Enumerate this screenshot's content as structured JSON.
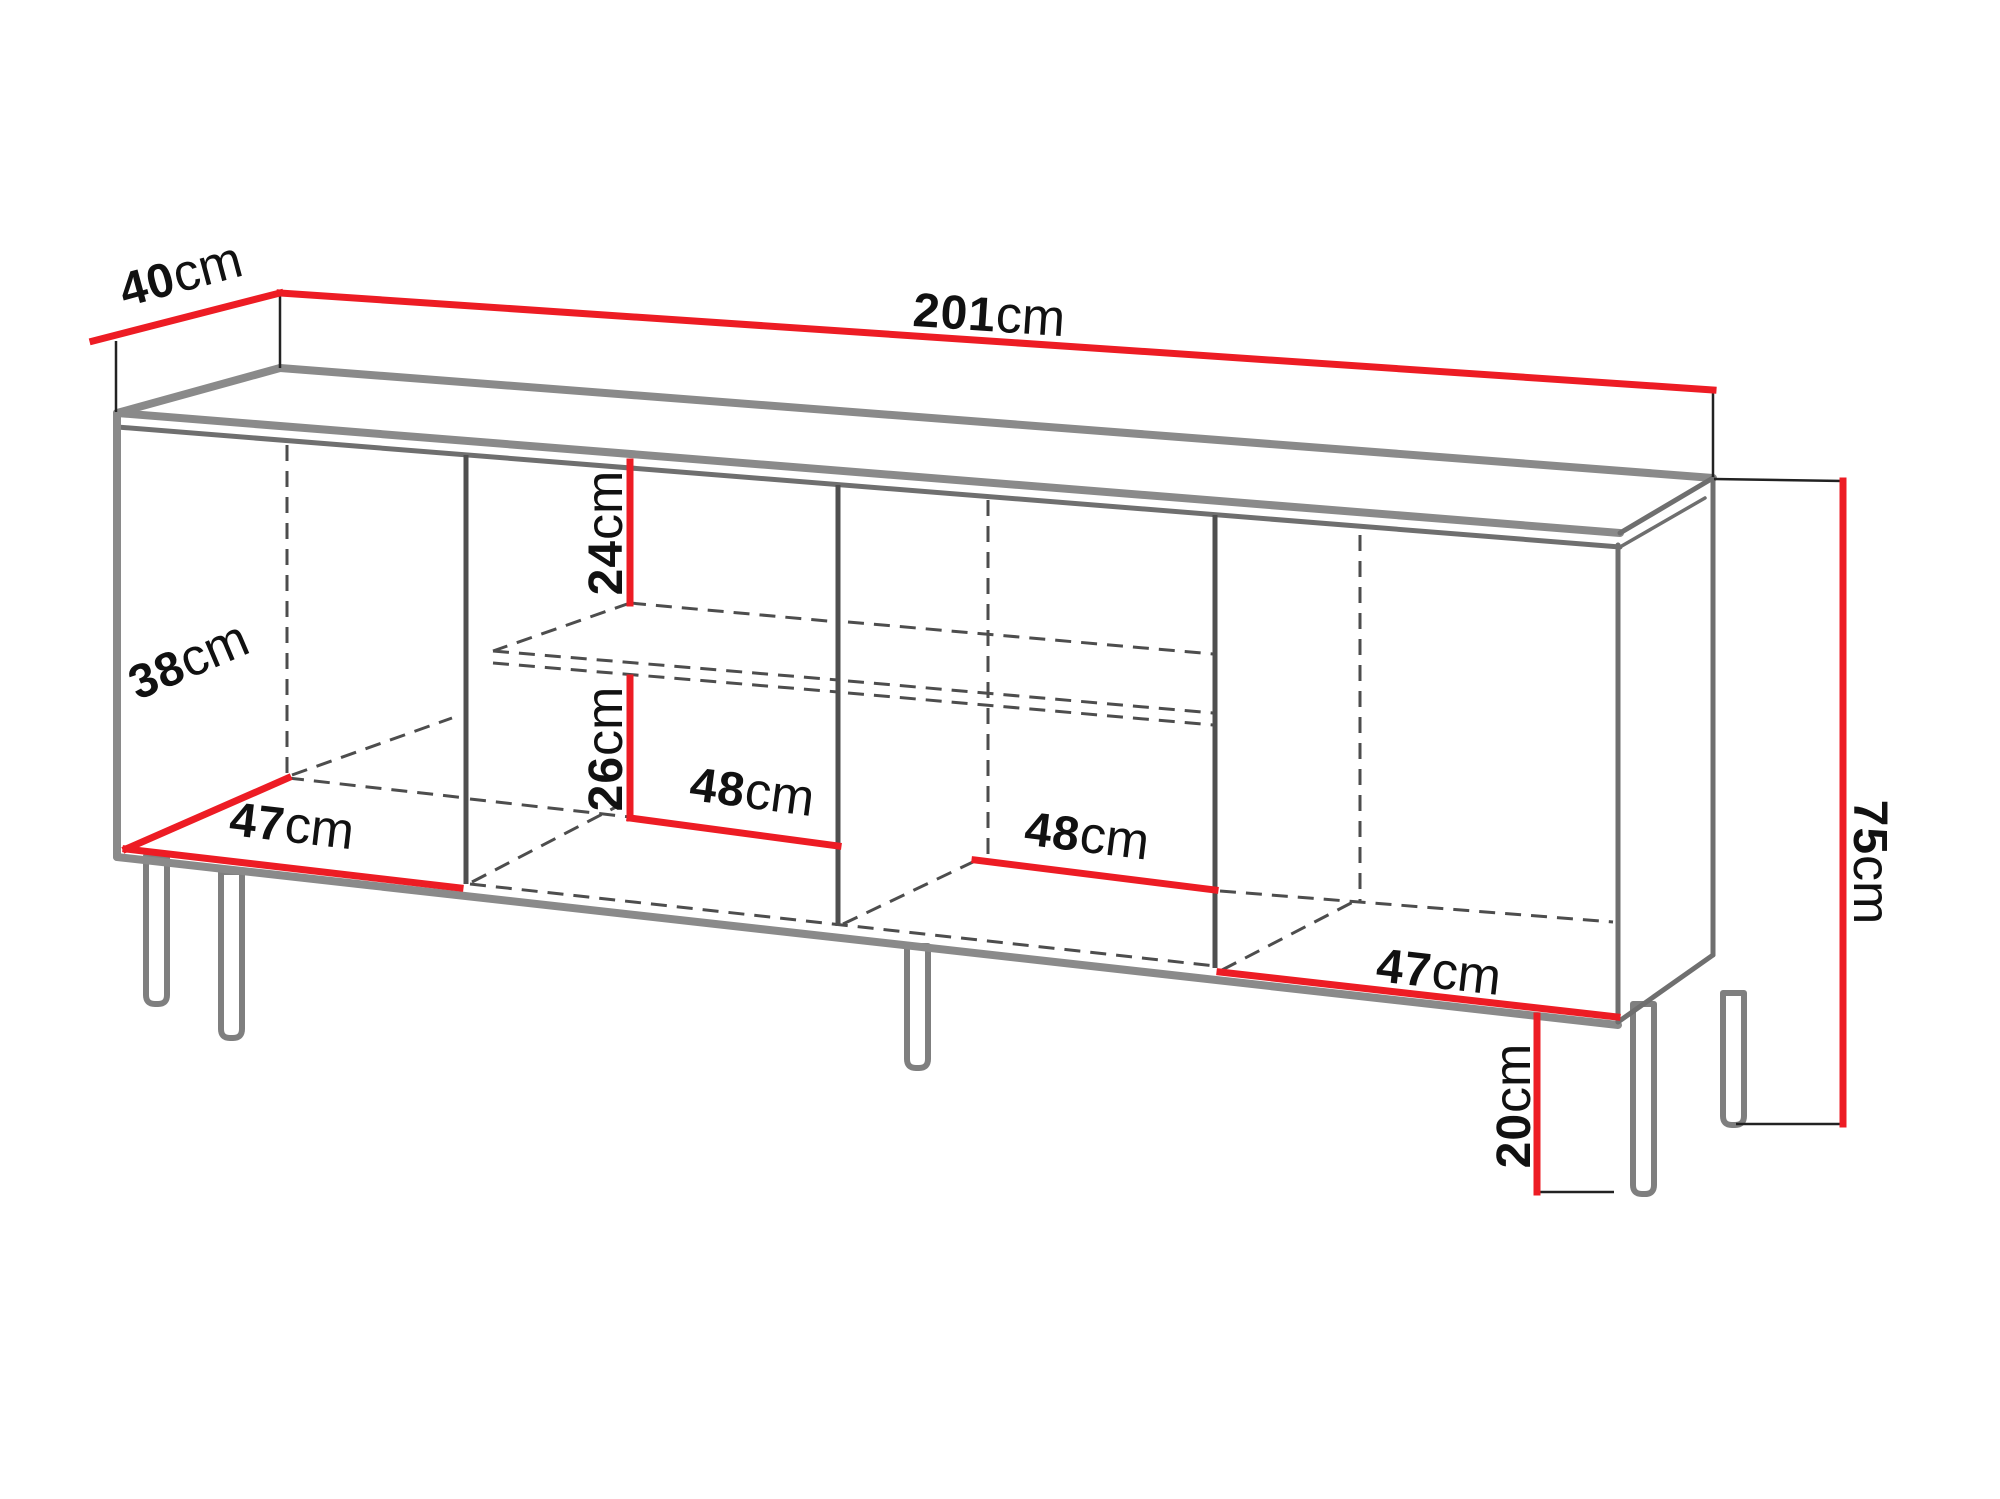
{
  "diagram": {
    "kind": "furniture-dimension-line-drawing",
    "subject": "four-section sideboard cabinet on legs, perspective view",
    "unit": "cm",
    "colors": {
      "dimension_line": "#ed1c24",
      "cabinet_outline": "#8a8a8a",
      "hidden_edge_dashed": "#4d4d4d",
      "label_text": "#111111",
      "background": "#ffffff"
    },
    "dimensions": {
      "total_width": "201 cm",
      "total_depth": "40 cm",
      "total_height": "75 cm",
      "leg_height": "20 cm",
      "interior_depth": "38 cm",
      "left_door_width": "47 cm",
      "right_door_width": "47 cm",
      "upper_shelf_clearance": "24 cm",
      "lower_shelf_clearance": "26 cm",
      "middle_left_compartment_width": "48 cm",
      "middle_right_compartment_width": "48 cm"
    }
  },
  "labels": {
    "d40": {
      "value": "40",
      "unit": "cm"
    },
    "d201": {
      "value": "201",
      "unit": "cm"
    },
    "d24": {
      "value": "24",
      "unit": "cm"
    },
    "d26": {
      "value": "26",
      "unit": "cm"
    },
    "d48a": {
      "value": "48",
      "unit": "cm"
    },
    "d48b": {
      "value": "48",
      "unit": "cm"
    },
    "d47a": {
      "value": "47",
      "unit": "cm"
    },
    "d38": {
      "value": "38",
      "unit": "cm"
    },
    "d47b": {
      "value": "47",
      "unit": "cm"
    },
    "d75": {
      "value": "75",
      "unit": "cm"
    },
    "d20": {
      "value": "20",
      "unit": "cm"
    }
  }
}
